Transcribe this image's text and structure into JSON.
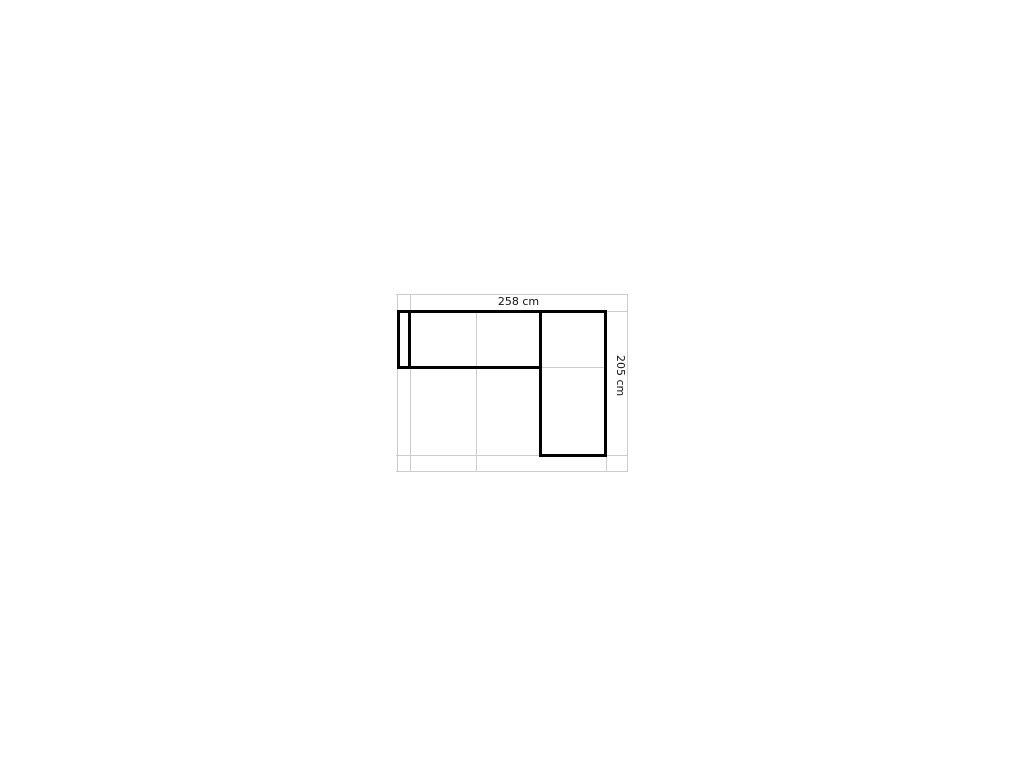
{
  "diagram": {
    "name": "sofa-configuration-top-view",
    "description": "L-shaped corner sofa outline with dimension labels on a light reference grid",
    "width_label": "258 cm",
    "height_label": "205 cm",
    "colors": {
      "outline": "#000000",
      "grid": "#cccccc",
      "label_text": "#111111",
      "background": "#ffffff"
    }
  }
}
